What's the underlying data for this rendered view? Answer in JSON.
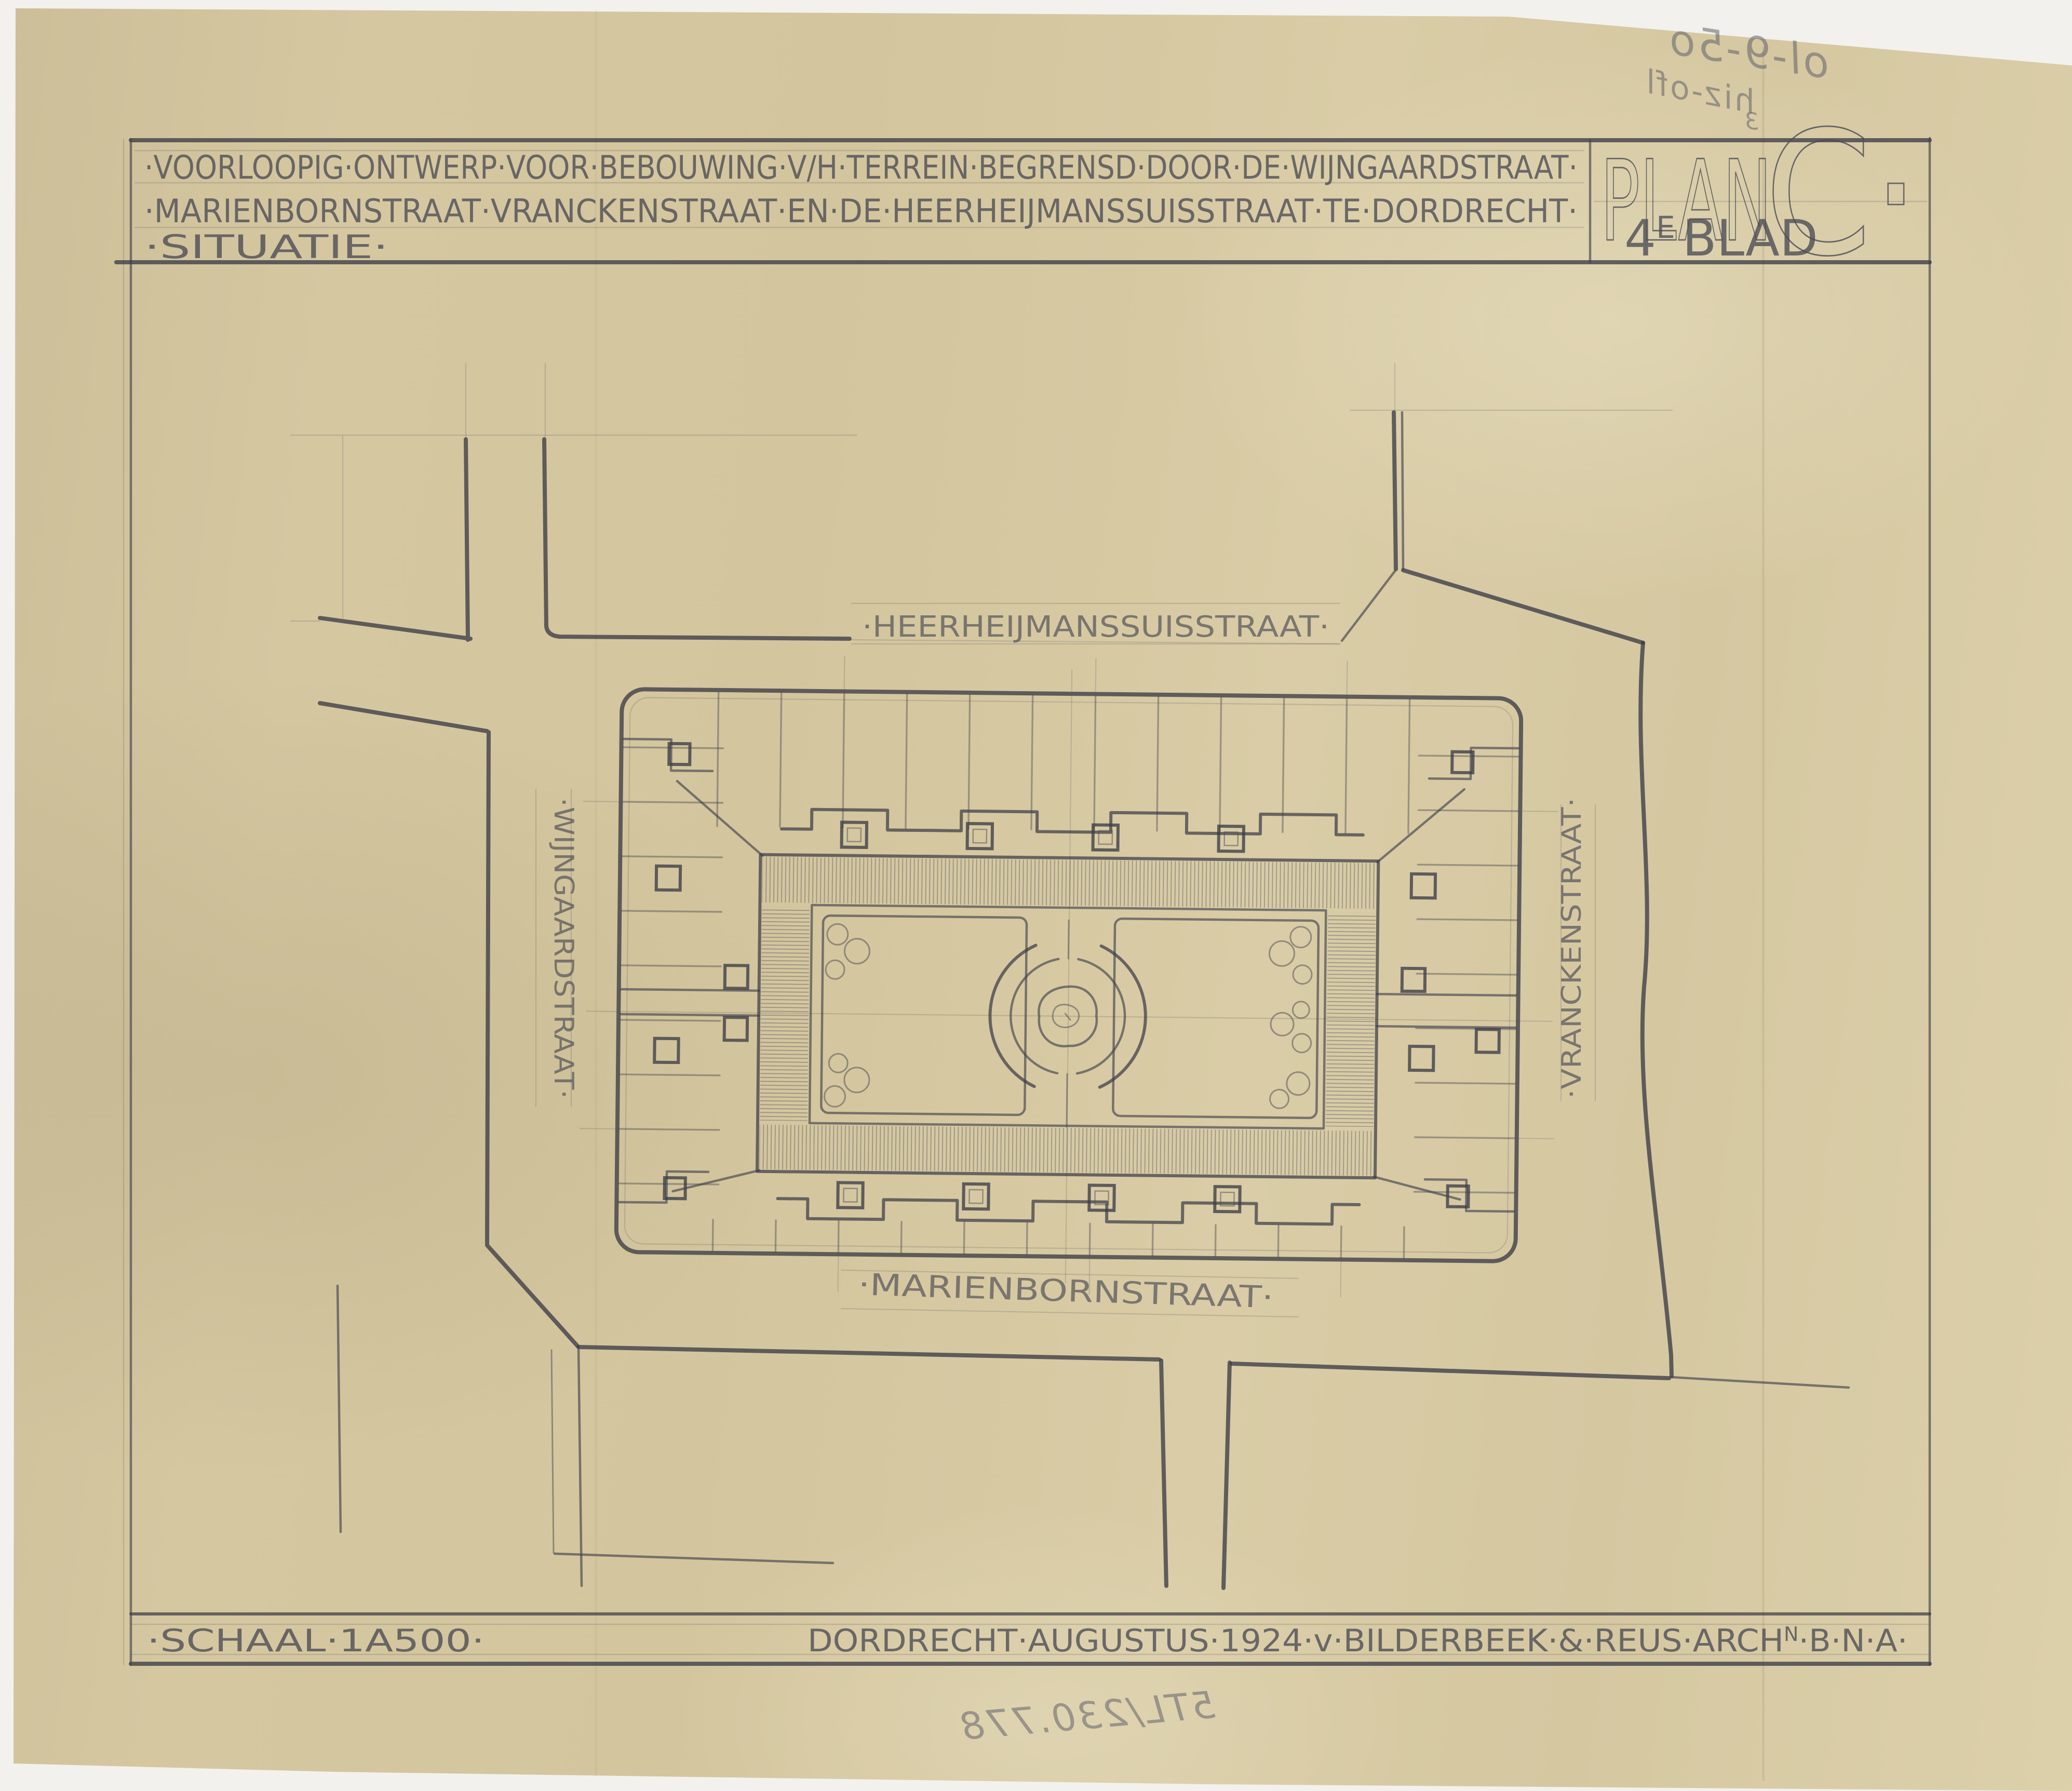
{
  "sheet": {
    "title_line1": "·VOORLOOPIG·ONTWERP·VOOR·BEBOUWING·V/H·TERREIN·BEGRENSD·DOOR·DE·WIJNGAARDSTRAAT·",
    "title_line2": "·MARIENBORNSTRAAT·VRANCKENSTRAAT·EN·DE·HEERHEIJMANSSUISSTRAAT·TE·DORDRECHT·",
    "title_line3": "·SITUATIE·",
    "plan_word": "PLAN",
    "plan_letter": "C·",
    "blad_num": "4",
    "blad_sup": "E",
    "blad_word": "BLAD",
    "scale_label": "·SCHAAL·1A500·",
    "credit_prefix": "DORDRECHT·AUGUSTUS·1924·v·BILDERBEEK·&·REUS·ARCH",
    "credit_sup": "N",
    "credit_suffix": "·B·N·A·"
  },
  "map": {
    "street_top": "·HEERHEIJMANSSUISSTRAAT·",
    "street_left": "·WIJNGAARDSTRAAT·",
    "street_right": "·VRANCKENSTRAAT·",
    "street_bottom": "·MARIENBORNSTRAAT·"
  },
  "annotations": {
    "handwritten_top_1": "ol-9-5o",
    "handwritten_top_2": "hiz-ofl",
    "handwritten_top_3": "3",
    "handwritten_bottom": "5TL/230.778"
  },
  "colors": {
    "paper": "#d5c8a1",
    "pencil": "#3c3c46",
    "scan_background": "#f2f1ed"
  }
}
